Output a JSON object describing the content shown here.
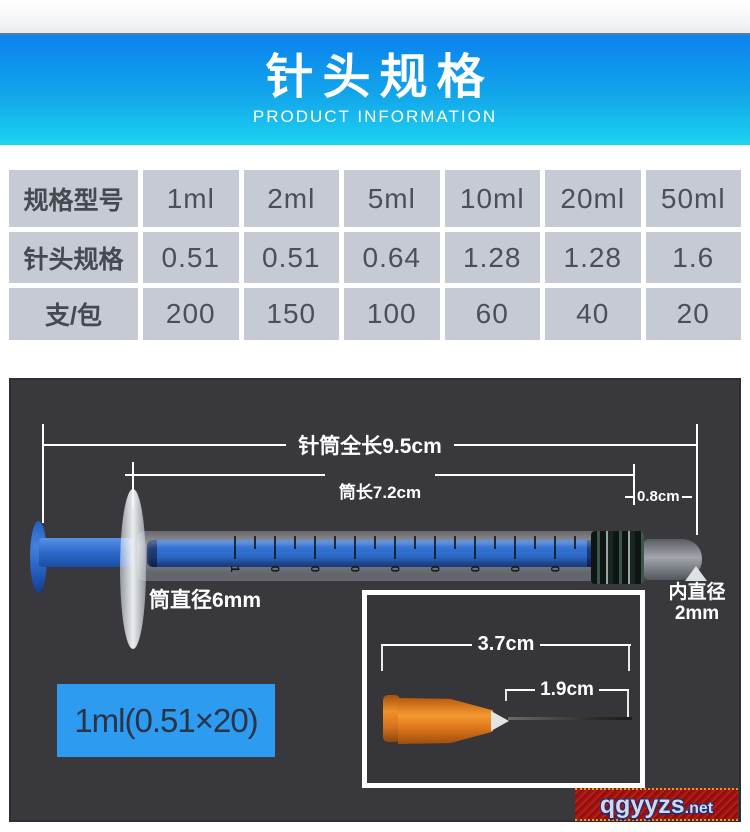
{
  "header": {
    "title": "针头规格",
    "subtitle": "PRODUCT INFORMATION"
  },
  "spec_table": {
    "rows": [
      {
        "label": "规格型号",
        "values": [
          "1ml",
          "2ml",
          "5ml",
          "10ml",
          "20ml",
          "50ml"
        ]
      },
      {
        "label": "针头规格",
        "values": [
          "0.51",
          "0.51",
          "0.64",
          "1.28",
          "1.28",
          "1.6"
        ]
      },
      {
        "label": "支/包",
        "values": [
          "200",
          "150",
          "100",
          "60",
          "40",
          "20"
        ]
      }
    ]
  },
  "diagram": {
    "total_length": "针筒全长9.5cm",
    "barrel_length": "筒长7.2cm",
    "tip_length": "0.8cm",
    "barrel_diameter": "筒直径6mm",
    "inner_diameter_line1": "内直径",
    "inner_diameter_line2": "2mm",
    "needle_total": "3.7cm",
    "needle_exposed": "1.9cm",
    "product_label": "1ml(0.51×20)",
    "barrel_scale": [
      "1",
      "0",
      "0",
      "0",
      "0",
      "0",
      "0",
      "0",
      "0",
      "0"
    ]
  },
  "watermark": {
    "name": "qgyyzs",
    "suffix": ".net"
  },
  "colors": {
    "banner_top": "#0b82ee",
    "banner_bottom": "#1ed3f2",
    "table_bg": "#c6cad5",
    "table_text": "#46494f",
    "panel_bg": "#38383d",
    "syringe_blue": "#2f6fd0",
    "plunger_blue": "#2a64c8",
    "label_bg": "#2d9bef",
    "label_text": "#2b3447",
    "needle_orange": "#e07a1e",
    "watermark_red": "#a31515",
    "watermark_text": "#d3d8e4"
  }
}
